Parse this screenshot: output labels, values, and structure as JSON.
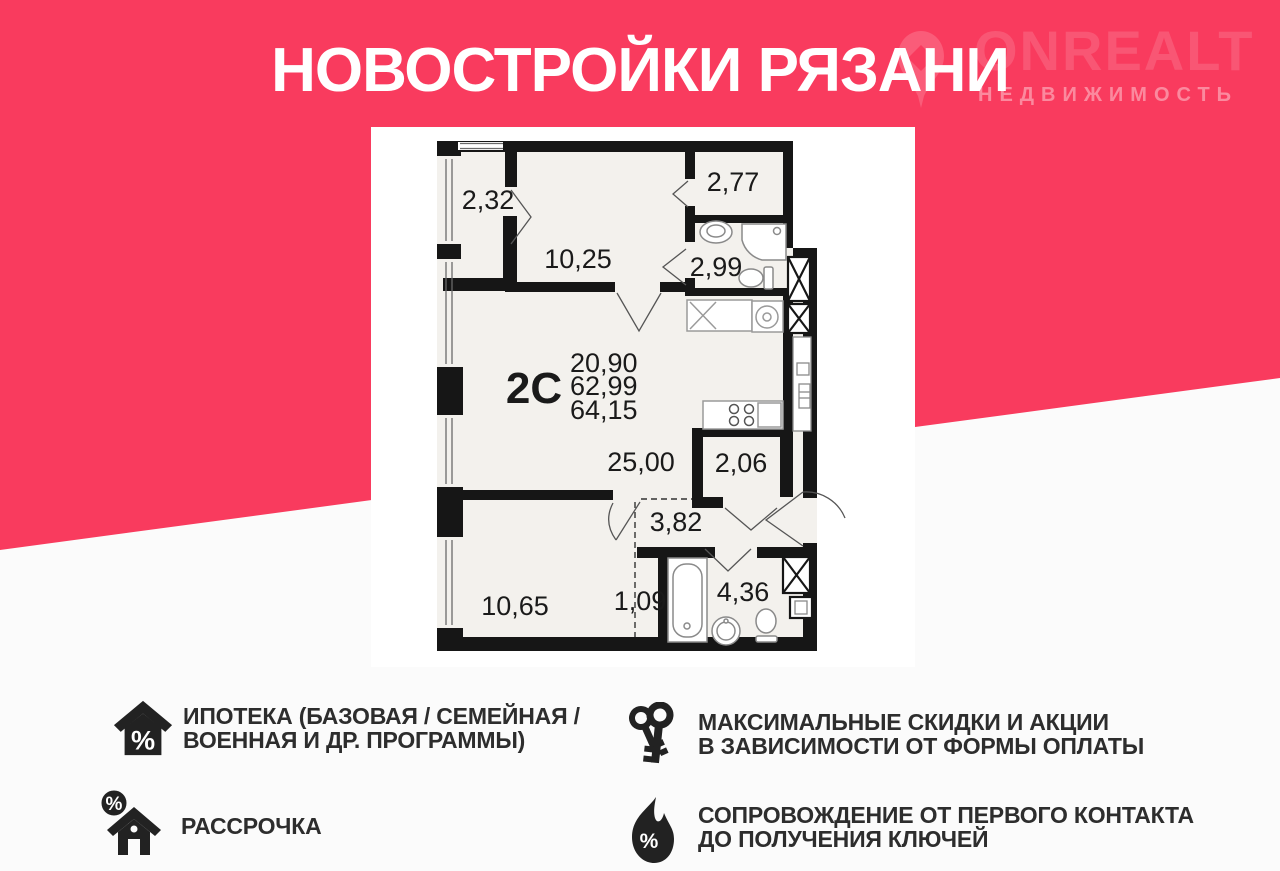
{
  "header": {
    "title": "НОВОСТРОЙКИ РЯЗАНИ"
  },
  "logo": {
    "brand": "ONREALT",
    "subtitle": "НЕДВИЖИМОСТЬ",
    "pin_icon": "map-pin-house-icon"
  },
  "plan": {
    "unit_type": "2С",
    "metrics": {
      "living_area": "20,90",
      "area_no_balcony": "62,99",
      "total_area": "64,15"
    },
    "rooms": [
      {
        "name": "loggia-left",
        "area": "2,32"
      },
      {
        "name": "room-top",
        "area": "10,25"
      },
      {
        "name": "loggia-right",
        "area": "2,77"
      },
      {
        "name": "bathroom-top",
        "area": "2,99"
      },
      {
        "name": "kitchen-living",
        "area": "25,00"
      },
      {
        "name": "wardrobe-right",
        "area": "2,06"
      },
      {
        "name": "hallway",
        "area": "3,82"
      },
      {
        "name": "bedroom",
        "area": "10,65"
      },
      {
        "name": "closet",
        "area": "1,09"
      },
      {
        "name": "bathroom-bottom",
        "area": "4,36"
      }
    ]
  },
  "features": [
    {
      "icon": "house-percent-icon",
      "lines": [
        "ИПОТЕКА (БАЗОВАЯ / СЕМЕЙНАЯ /",
        "ВОЕННАЯ И ДР. ПРОГРАММЫ)"
      ]
    },
    {
      "icon": "house-installment-icon",
      "lines": [
        "РАССРОЧКА"
      ]
    },
    {
      "icon": "keys-icon",
      "lines": [
        "МАКСИМАЛЬНЫЕ СКИДКИ И АКЦИИ",
        "В ЗАВИСИМОСТИ ОТ ФОРМЫ ОПЛАТЫ"
      ]
    },
    {
      "icon": "flame-percent-icon",
      "lines": [
        "СОПРОВОЖДЕНИЕ ОТ ПЕРВОГО КОНТАКТА",
        "ДО ПОЛУЧЕНИЯ КЛЮЧЕЙ"
      ]
    }
  ],
  "icons": {
    "percent": "%"
  },
  "colors": {
    "accent_pink": "#f93b5e",
    "text_dark": "#2d2d2d",
    "wall_black": "#161616",
    "plan_floor": "#f3f1ed"
  }
}
